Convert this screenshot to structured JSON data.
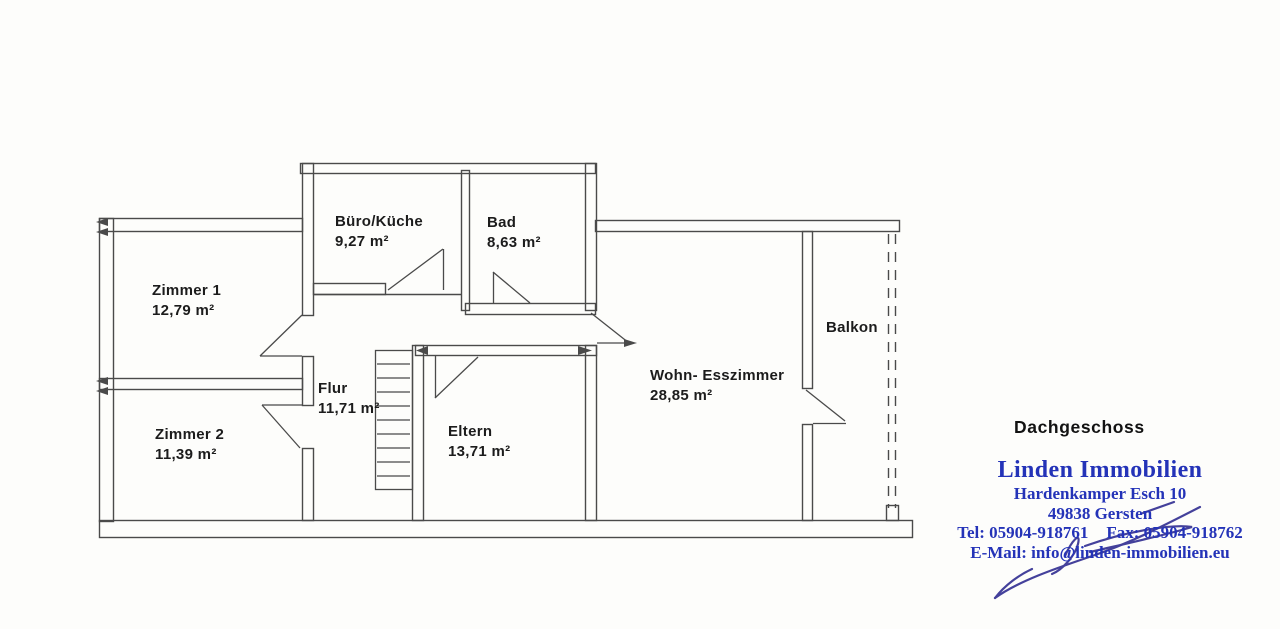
{
  "plan": {
    "title": "Dachgeschoss",
    "rooms": [
      {
        "name": "Zimmer 1",
        "area": "12,79 m²"
      },
      {
        "name": "Zimmer 2",
        "area": "11,39 m²"
      },
      {
        "name": "Büro/Küche",
        "area": "9,27 m²"
      },
      {
        "name": "Bad",
        "area": "8,63 m²"
      },
      {
        "name": "Flur",
        "area": "11,71 m²"
      },
      {
        "name": "Eltern",
        "area": "13,71 m²"
      },
      {
        "name": "Wohn- Esszimmer",
        "area": "28,85 m²"
      },
      {
        "name": "Balkon",
        "area": ""
      }
    ]
  },
  "agency": {
    "name": "Linden Immobilien",
    "street": "Hardenkamper Esch 10",
    "city": "49838 Gersten",
    "phone": "Tel: 05904-918761",
    "fax": "Fax: 05904-918762",
    "email": "E-Mail: info@linden-immobilien.eu"
  },
  "colors": {
    "plan_line": "#4a4a4a",
    "label_text": "#1c1c1c",
    "brand_blue": "#2433b8",
    "signature_ink": "#44419b"
  }
}
